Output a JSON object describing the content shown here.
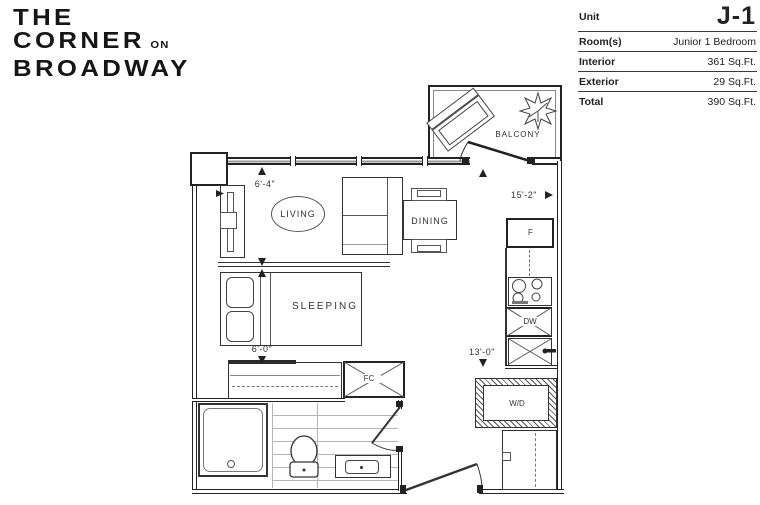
{
  "branding": {
    "title_line1": "THE",
    "title_line2": "CORNER",
    "title_line2_suffix": "ON",
    "title_line3": "BROADWAY"
  },
  "unit_info": {
    "rows": [
      {
        "label": "Unit",
        "value": "J-1"
      },
      {
        "label": "Room(s)",
        "value": "Junior 1 Bedroom"
      },
      {
        "label": "Interior",
        "value": "361 Sq.Ft."
      },
      {
        "label": "Exterior",
        "value": "29 Sq.Ft."
      },
      {
        "label": "Total",
        "value": "390 Sq.Ft."
      }
    ]
  },
  "floorplan": {
    "labels": {
      "balcony": "BALCONY",
      "living": "LIVING",
      "dining": "DINING",
      "sleeping": "SLEEPING"
    },
    "fixtures": {
      "fridge": "F",
      "dishwasher": "DW",
      "fan_coil": "FC",
      "washer_dryer": "W/D"
    },
    "dimensions": {
      "living_width": "6'-4\"",
      "overall_width": "15'-2\"",
      "sleeping_width": "6'-0\"",
      "overall_depth": "13'-0\""
    }
  },
  "colors": {
    "line": "#333333",
    "wall": "#1f1f1f",
    "background": "#ffffff"
  }
}
